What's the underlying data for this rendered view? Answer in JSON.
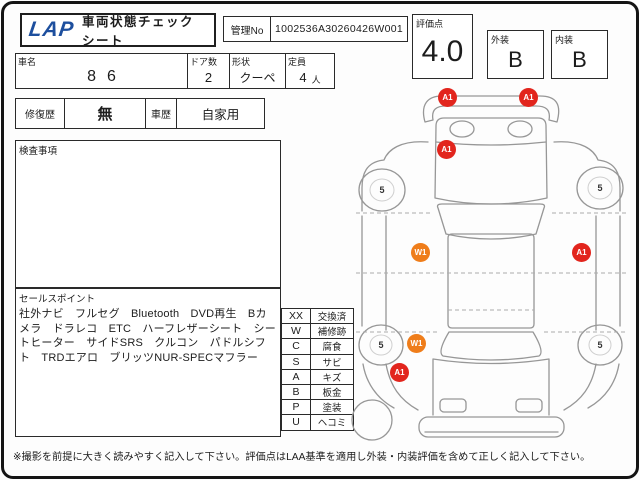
{
  "colors": {
    "logo_blue": "#1d4f9e",
    "marker_red": "#e2251d",
    "marker_orange": "#ef7d1a",
    "outline_gray": "#979797"
  },
  "header": {
    "logo_text": "LAP",
    "title": "車両状態チェックシート",
    "management_no_label": "管理No",
    "management_no_value": "1002536A30260426W001"
  },
  "scores": {
    "overall_label": "評価点",
    "overall_value": "4.0",
    "exterior_label": "外装",
    "exterior_value": "B",
    "interior_label": "内装",
    "interior_value": "B"
  },
  "vehicle": {
    "name_label": "車名",
    "name_value": "86",
    "doors_label": "ドア数",
    "doors_value": "2",
    "shape_label": "形状",
    "shape_value": "クーペ",
    "capacity_label": "定員",
    "capacity_value": "4",
    "capacity_unit": "人",
    "repair_label": "修復歴",
    "repair_value": "無",
    "history_label": "車歴",
    "history_value": "自家用"
  },
  "inspection": {
    "label": "検査事項",
    "content": ""
  },
  "sales": {
    "label": "セールスポイント",
    "content": "社外ナビ　フルセグ　Bluetooth　DVD再生　Bカメラ　ドラレコ　ETC　ハーフレザーシート　シートヒーター　サイドSRS　クルコン　パドルシフト　TRDエアロ　ブリッツNUR-SPECマフラー"
  },
  "legend": {
    "rows": [
      {
        "code": "XX",
        "label": "交換済"
      },
      {
        "code": "W",
        "label": "補修跡"
      },
      {
        "code": "C",
        "label": "腐食"
      },
      {
        "code": "S",
        "label": "サビ"
      },
      {
        "code": "A",
        "label": "キズ"
      },
      {
        "code": "B",
        "label": "板金"
      },
      {
        "code": "P",
        "label": "塗装"
      },
      {
        "code": "U",
        "label": "ヘコミ"
      }
    ]
  },
  "diagram": {
    "markers": [
      {
        "label": "A1",
        "color": "#e2251d",
        "position": "front-bumper-left"
      },
      {
        "label": "A1",
        "color": "#e2251d",
        "position": "front-bumper-right"
      },
      {
        "label": "A1",
        "color": "#e2251d",
        "position": "hood-left"
      },
      {
        "label": "W1",
        "color": "#ef7d1a",
        "position": "left-door"
      },
      {
        "label": "A1",
        "color": "#e2251d",
        "position": "right-door"
      },
      {
        "label": "W1",
        "color": "#ef7d1a",
        "position": "left-rear-wheel-arch"
      },
      {
        "label": "A1",
        "color": "#e2251d",
        "position": "left-rear-quarter"
      }
    ],
    "tire_depths": [
      {
        "label": "5",
        "position": "front-left"
      },
      {
        "label": "5",
        "position": "front-right"
      },
      {
        "label": "5",
        "position": "rear-left"
      },
      {
        "label": "5",
        "position": "rear-right"
      }
    ]
  },
  "footer": {
    "note": "※撮影を前提に大きく読みやすく記入して下さい。評価点はLAA基準を適用し外装・内装評価を含めて正しく記入して下さい。"
  }
}
